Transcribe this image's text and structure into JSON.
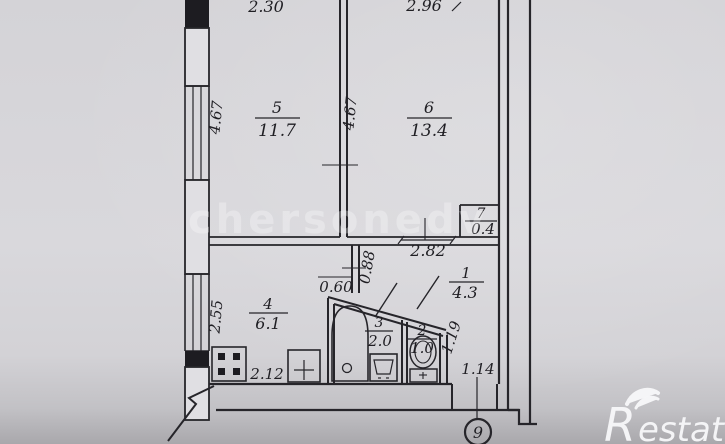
{
  "plan": {
    "rooms": [
      {
        "number": "1",
        "area": "4.3"
      },
      {
        "number": "2",
        "area": "1.0"
      },
      {
        "number": "3",
        "area": "2.0"
      },
      {
        "number": "4",
        "area": "6.1"
      },
      {
        "number": "5",
        "area": "11.7"
      },
      {
        "number": "6",
        "area": "13.4"
      },
      {
        "number": "7",
        "area": "0.4"
      }
    ],
    "dimensions": {
      "top_left": "2.30",
      "top_right": "2.96",
      "left_room5": "4.67",
      "mid_room6": "4.67",
      "hall": "2.82",
      "closet_gap": "0.88",
      "bath_door": "0.60",
      "kitchen_left": "2.55",
      "kitchen_bottom": "2.12",
      "hall_right": "1.19",
      "entrance": "1.14"
    },
    "entrance_marker": "9"
  },
  "watermark": {
    "center_text": "chersonedv",
    "brand_r": "R",
    "brand_rest": "estate"
  },
  "colors": {
    "paper": "#d7d6da",
    "ink": "#26252a",
    "brand_white": "#f8f8fa"
  }
}
